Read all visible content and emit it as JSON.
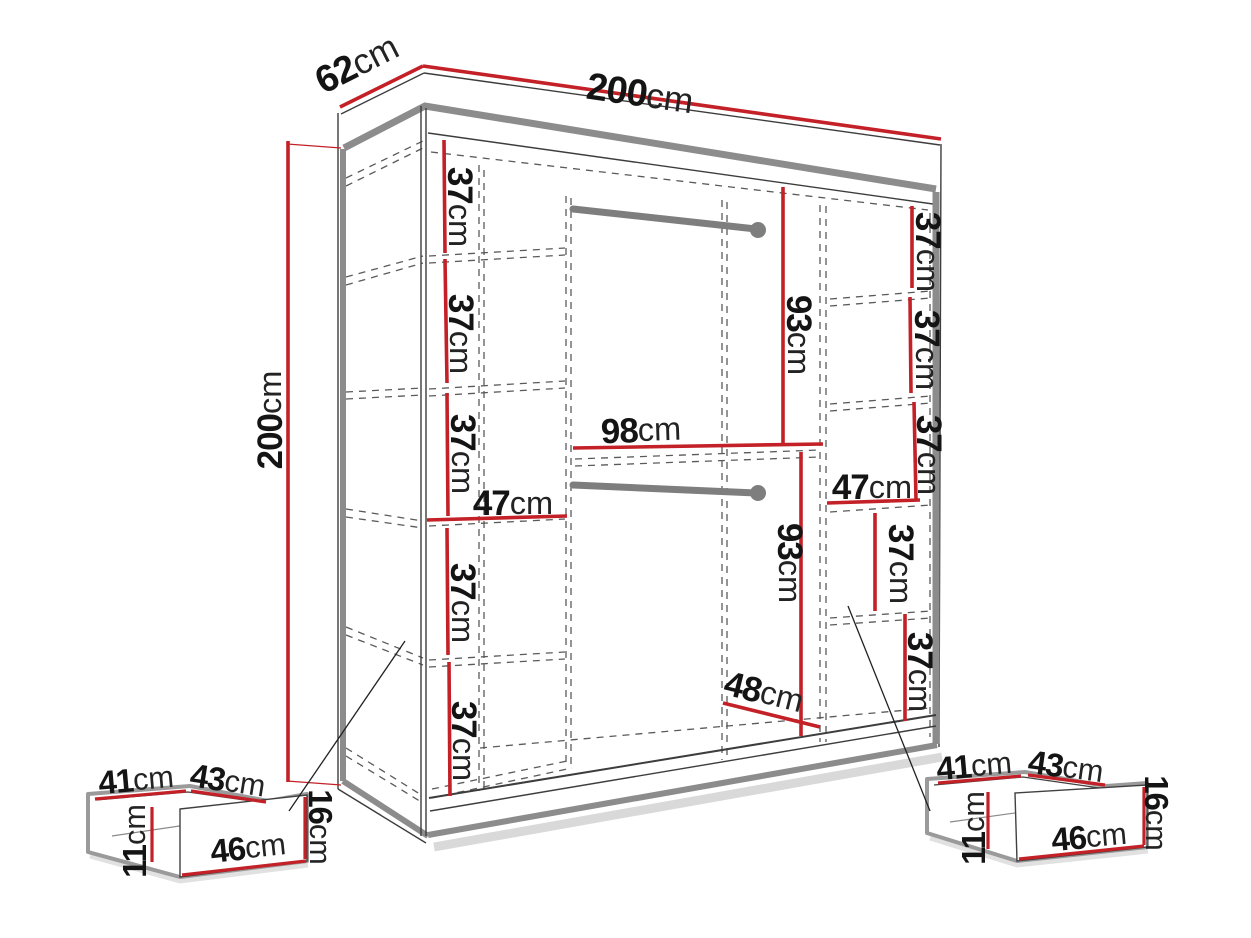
{
  "diagram": {
    "kind": "furniture dimension diagram",
    "subject": "wardrobe with interior shelf columns, two hanging rails and two pull-out drawers"
  },
  "colors": {
    "dimension_line": "#c32127",
    "edge_gray": "#8c8c8c",
    "hidden_line": "#5a5a5a",
    "rod_gray": "#7e7e7e",
    "label_text": "#141414",
    "background": "#ffffff"
  },
  "wardrobe": {
    "width": {
      "value": "200",
      "unit": "cm"
    },
    "depth": {
      "value": "62",
      "unit": "cm"
    },
    "height": {
      "value": "200",
      "unit": "cm"
    },
    "left_column": {
      "width": {
        "value": "47",
        "unit": "cm"
      },
      "gap_1": {
        "value": "37",
        "unit": "cm"
      },
      "gap_2": {
        "value": "37",
        "unit": "cm"
      },
      "gap_3": {
        "value": "37",
        "unit": "cm"
      },
      "gap_4": {
        "value": "37",
        "unit": "cm"
      },
      "gap_5": {
        "value": "37",
        "unit": "cm"
      }
    },
    "center_section": {
      "width": {
        "value": "98",
        "unit": "cm"
      },
      "upper_rail_drop": {
        "value": "93",
        "unit": "cm"
      },
      "lower_rail_drop": {
        "value": "93",
        "unit": "cm"
      },
      "depth": {
        "value": "48",
        "unit": "cm"
      }
    },
    "right_column": {
      "width": {
        "value": "47",
        "unit": "cm"
      },
      "gap_1": {
        "value": "37",
        "unit": "cm"
      },
      "gap_2": {
        "value": "37",
        "unit": "cm"
      },
      "gap_3": {
        "value": "37",
        "unit": "cm"
      },
      "gap_4": {
        "value": "37",
        "unit": "cm"
      },
      "gap_5": {
        "value": "37",
        "unit": "cm"
      }
    }
  },
  "drawer_left": {
    "top_depth": {
      "value": "41",
      "unit": "cm"
    },
    "top_width": {
      "value": "43",
      "unit": "cm"
    },
    "front_width": {
      "value": "46",
      "unit": "cm"
    },
    "height": {
      "value": "16",
      "unit": "cm"
    },
    "side_height": {
      "value": "11",
      "unit": "cm"
    }
  },
  "drawer_right": {
    "top_depth": {
      "value": "41",
      "unit": "cm"
    },
    "top_width": {
      "value": "43",
      "unit": "cm"
    },
    "front_width": {
      "value": "46",
      "unit": "cm"
    },
    "height": {
      "value": "16",
      "unit": "cm"
    },
    "side_height": {
      "value": "11",
      "unit": "cm"
    }
  }
}
